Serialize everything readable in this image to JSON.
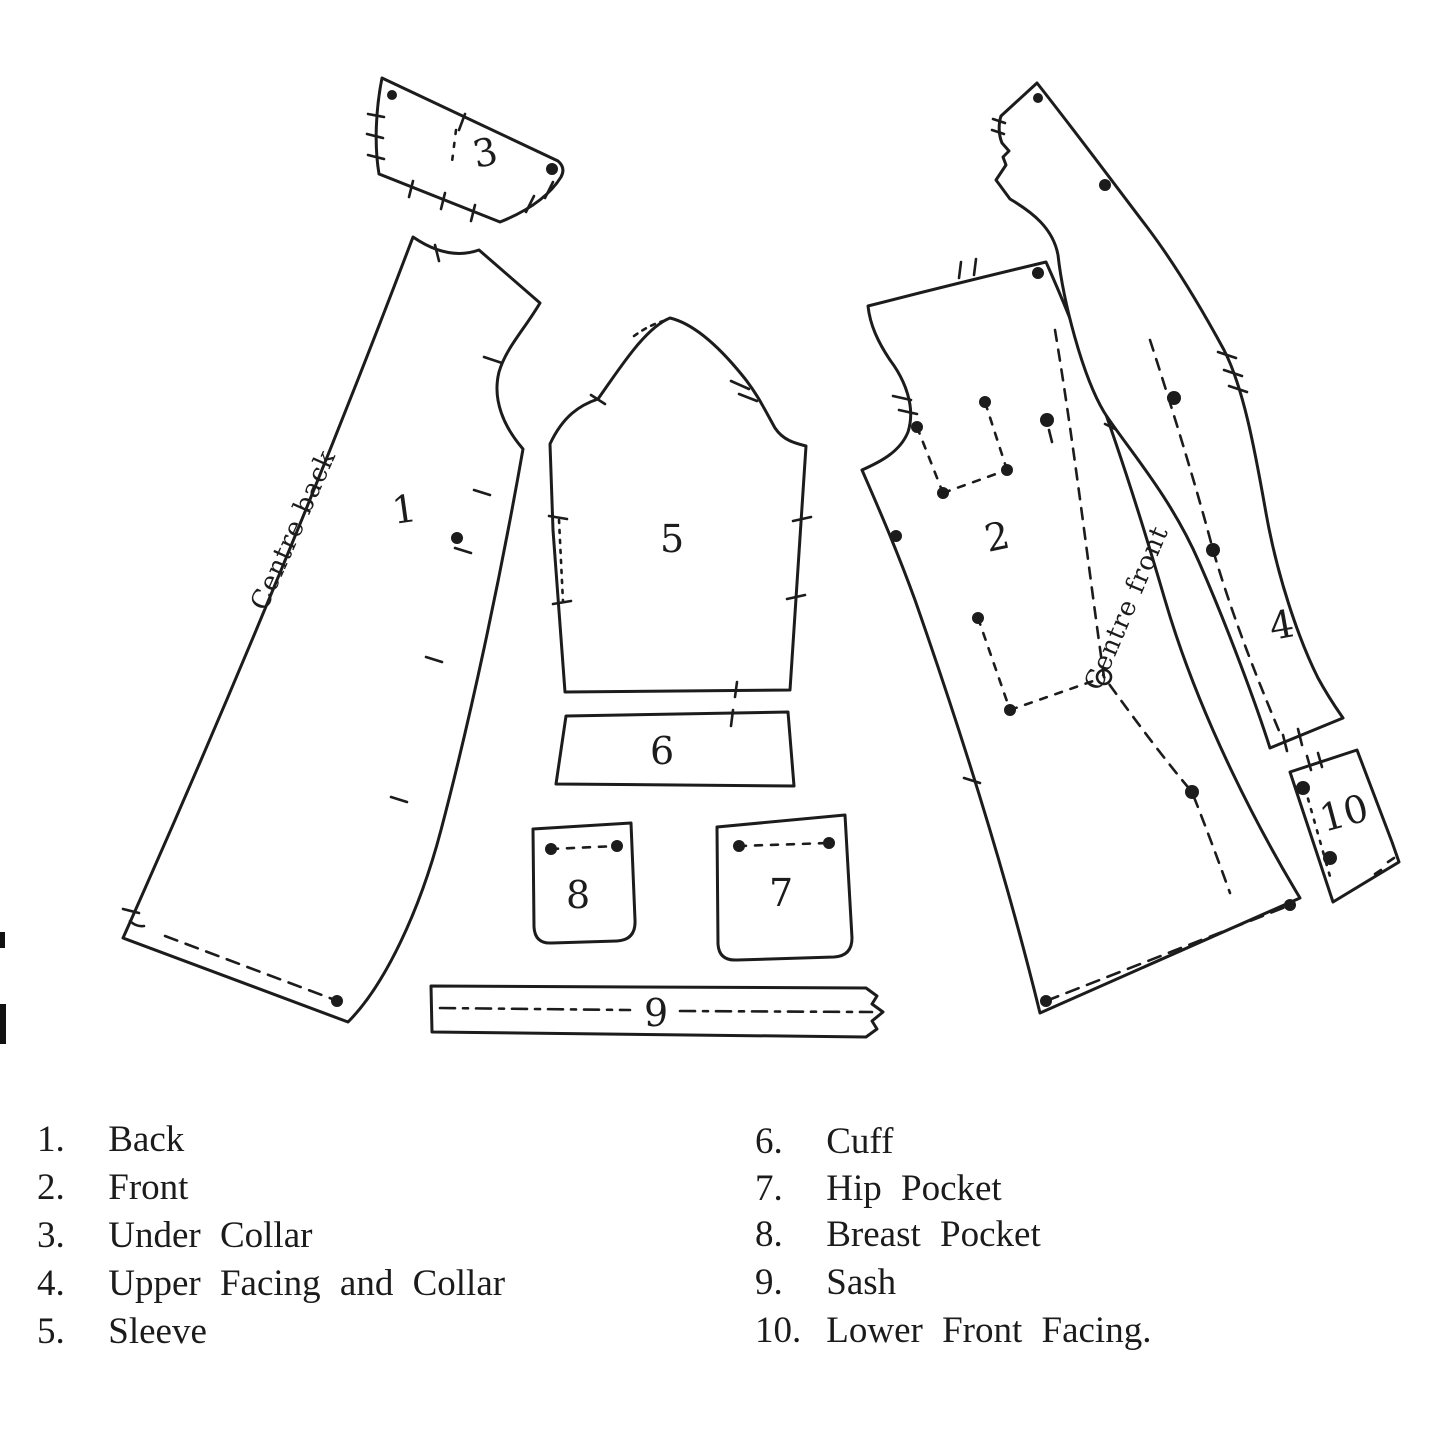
{
  "figure": {
    "background": "#ffffff",
    "ink": "#1c1c1c",
    "type": "sewing-pattern-diagram"
  },
  "pieces": [
    {
      "num": "1",
      "name": "Back"
    },
    {
      "num": "2",
      "name": "Front"
    },
    {
      "num": "3",
      "name": "Under Collar"
    },
    {
      "num": "4",
      "name": "Upper Facing and Collar"
    },
    {
      "num": "5",
      "name": "Sleeve"
    },
    {
      "num": "6",
      "name": "Cuff"
    },
    {
      "num": "7",
      "name": "Hip Pocket"
    },
    {
      "num": "8",
      "name": "Breast Pocket"
    },
    {
      "num": "9",
      "name": "Sash"
    },
    {
      "num": "10",
      "name": "Lower Front Facing"
    }
  ],
  "annotations": {
    "centre_back": "Centre back",
    "centre_front": "Centre front"
  },
  "legend": {
    "left": [
      {
        "num": "1.",
        "label": "Back"
      },
      {
        "num": "2.",
        "label": "Front"
      },
      {
        "num": "3.",
        "label": "Under Collar"
      },
      {
        "num": "4.",
        "label": "Upper Facing and Collar"
      },
      {
        "num": "5.",
        "label": "Sleeve"
      }
    ],
    "right": [
      {
        "num": "6.",
        "label": "Cuff"
      },
      {
        "num": "7.",
        "label": "Hip Pocket"
      },
      {
        "num": "8.",
        "label": "Breast Pocket"
      },
      {
        "num": "9.",
        "label": "Sash"
      },
      {
        "num": "10.",
        "label": "Lower Front Facing."
      }
    ]
  }
}
